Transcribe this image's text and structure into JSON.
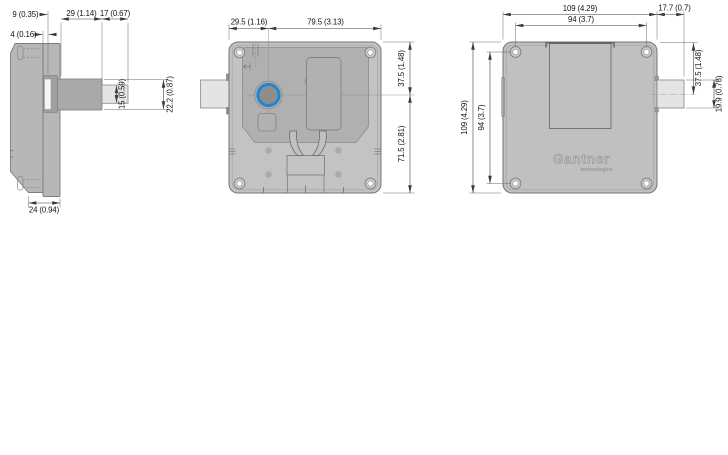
{
  "colors": {
    "background": "#ffffff",
    "body_fill": "#c3c3c3",
    "side_body_fill": "#b7b7b7",
    "panel_fill": "#b0b0b0",
    "bolt_shaft_fill": "#a9a9a9",
    "bolt_tip_fill": "#e4e4e4",
    "knob_ring_blue": "#1f86d0",
    "outline_gray": "#787878",
    "dimension_line": "#3f3f3f"
  },
  "views": {
    "side": {
      "dims": {
        "d9": "9 (0.35)",
        "d4": "4 (0.16)",
        "d29": "29 (1.14)",
        "d17": "17 (0.67)",
        "d15": "15 (0.59)",
        "d22_2": "22.2 (0.87)",
        "d24": "24 (0.94)"
      }
    },
    "back": {
      "dims": {
        "d29_5": "29.5 (1.16)",
        "d79_5": "79.5 (3.13)",
        "d37_5": "37.5 (1.48)",
        "d71_5": "71.5 (2.81)"
      }
    },
    "front": {
      "logo": {
        "brand": "Gantner",
        "tagline": "technologies"
      },
      "dims": {
        "d109_top": "109 (4.29)",
        "d17_7": "17.7 (0.7)",
        "d94_top": "94 (3.7)",
        "d109_left": "109 (4.29)",
        "d94_left": "94 (3.7)",
        "d37_5": "37.5 (1.48)",
        "d19_9": "19.9 (0.78)"
      }
    }
  }
}
